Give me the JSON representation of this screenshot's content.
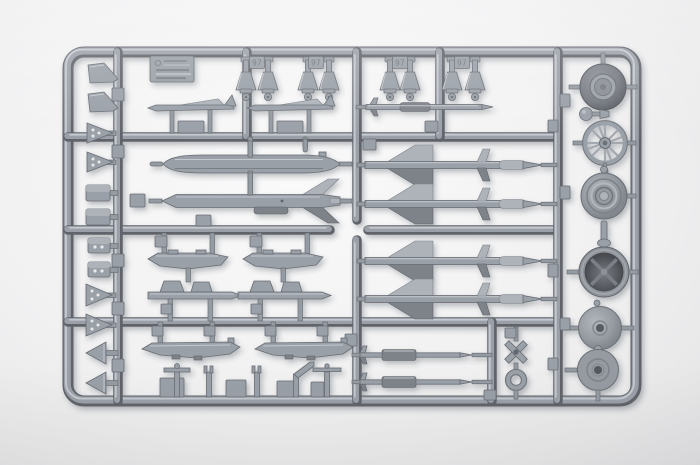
{
  "photo": {
    "subject": "Gray injection-molded plastic model kit sprue with aircraft weapons, pylons and wheels, photographed on a white background",
    "background_color": "#efeff0",
    "plastic_color": "#9aa0a8",
    "plastic_shadow_color": "#60646b",
    "plastic_highlight_color": "#c9cdd3"
  },
  "molded_marks": {
    "tag_text": "97"
  },
  "parts_inventory": {
    "top_row": [
      "maker-plate",
      "nozzle-cone x8",
      "winged-bomb x2",
      "slender-missile"
    ],
    "left_rail": [
      "wedge-fin x2",
      "perforated-fin x2",
      "pylon-block x2",
      "drilled-block x2",
      "drilled-arrow-fin x2",
      "arrow-fin x2"
    ],
    "middle_left": [
      "drop-tank",
      "cruise-missile",
      "weapon-pylon x2",
      "launch-rail x2",
      "tank-half x2",
      "antenna-post x5"
    ],
    "middle_right": [
      "finned-missile x4",
      "small-missile x2",
      "cruciform-fin",
      "tow-ring"
    ],
    "right_column": [
      "main-wheel-tire",
      "ball-joint",
      "spoked-wheel",
      "hub-wheel",
      "intake-housing",
      "wheel-disc x2"
    ]
  }
}
